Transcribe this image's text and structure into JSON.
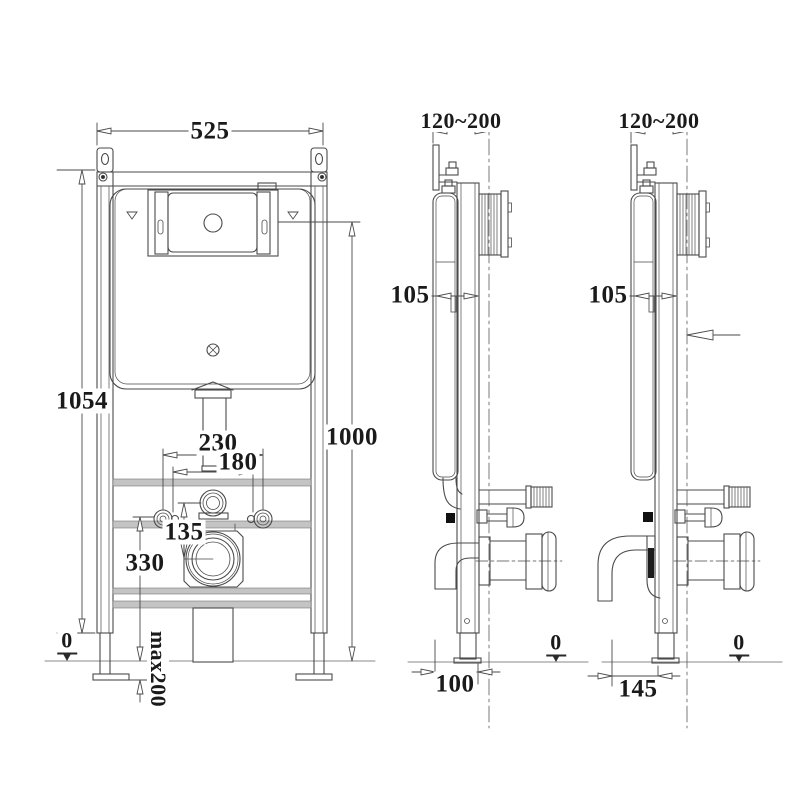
{
  "drawing_title": "concealed-cistern-wc-frame-installation-drawing",
  "colors": {
    "line": "#4a4a4a",
    "text": "#1a1a1a",
    "background": "#ffffff",
    "rail_fill": "#c4c4c4"
  },
  "labels": {
    "front": {
      "width": "525",
      "height_total": "1054",
      "height_flush": "1000",
      "bolt_spacing": "230",
      "drain_spacing": "180",
      "inlet_offset": "135",
      "outlet_height": "330",
      "datum": "0",
      "foot_adjust": "max200"
    },
    "side_mid": {
      "wall_thickness": "120~200",
      "frame_depth": "105",
      "floor_offset": "100",
      "datum": "0"
    },
    "side_right": {
      "wall_thickness": "120~200",
      "frame_depth": "105",
      "floor_offset": "145",
      "datum": "0"
    }
  }
}
